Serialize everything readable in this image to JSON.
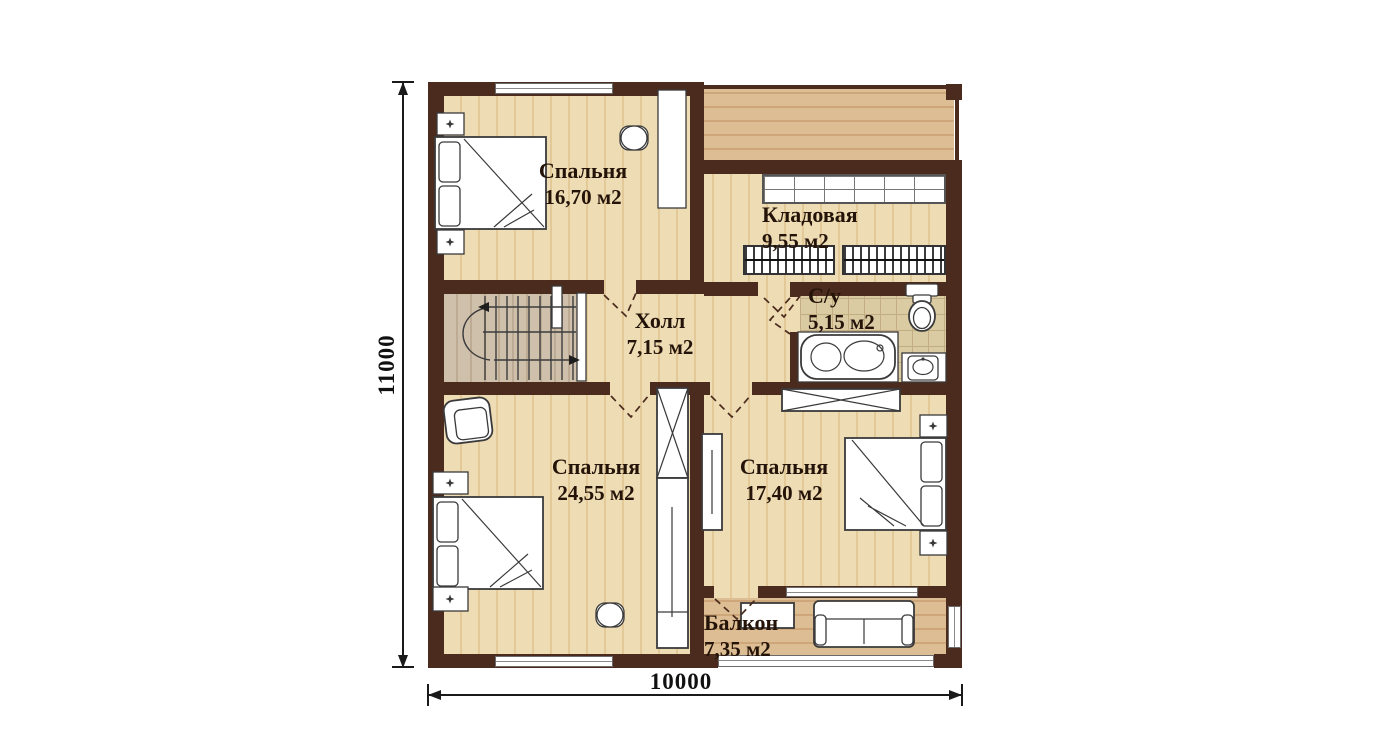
{
  "plan": {
    "rooms": [
      {
        "key": "bedroom-top-left",
        "name": "Спальня",
        "area": "16,70 м2"
      },
      {
        "key": "storage",
        "name": "Кладовая",
        "area": "9,55 м2"
      },
      {
        "key": "hall",
        "name": "Холл",
        "area": "7,15 м2"
      },
      {
        "key": "bathroom",
        "name": "С/у",
        "area": "5,15 м2"
      },
      {
        "key": "bedroom-bottom-left",
        "name": "Спальня",
        "area": "24,55 м2"
      },
      {
        "key": "bedroom-bottom-right",
        "name": "Спальня",
        "area": "17,40 м2"
      },
      {
        "key": "balcony",
        "name": "Балкон",
        "area": "7,35 м2"
      }
    ],
    "dimensions": {
      "vertical": "11000",
      "horizontal": "10000"
    },
    "colors": {
      "wall": "#4b2b1d",
      "floor_light": "#ecd9b0",
      "floor_dark": "#d7b68a",
      "floor_stairs": "#c9b8a2",
      "bathroom_tile": "#dbcba3",
      "label_text": "#241309",
      "dimension_line": "#1a1a1a"
    }
  }
}
